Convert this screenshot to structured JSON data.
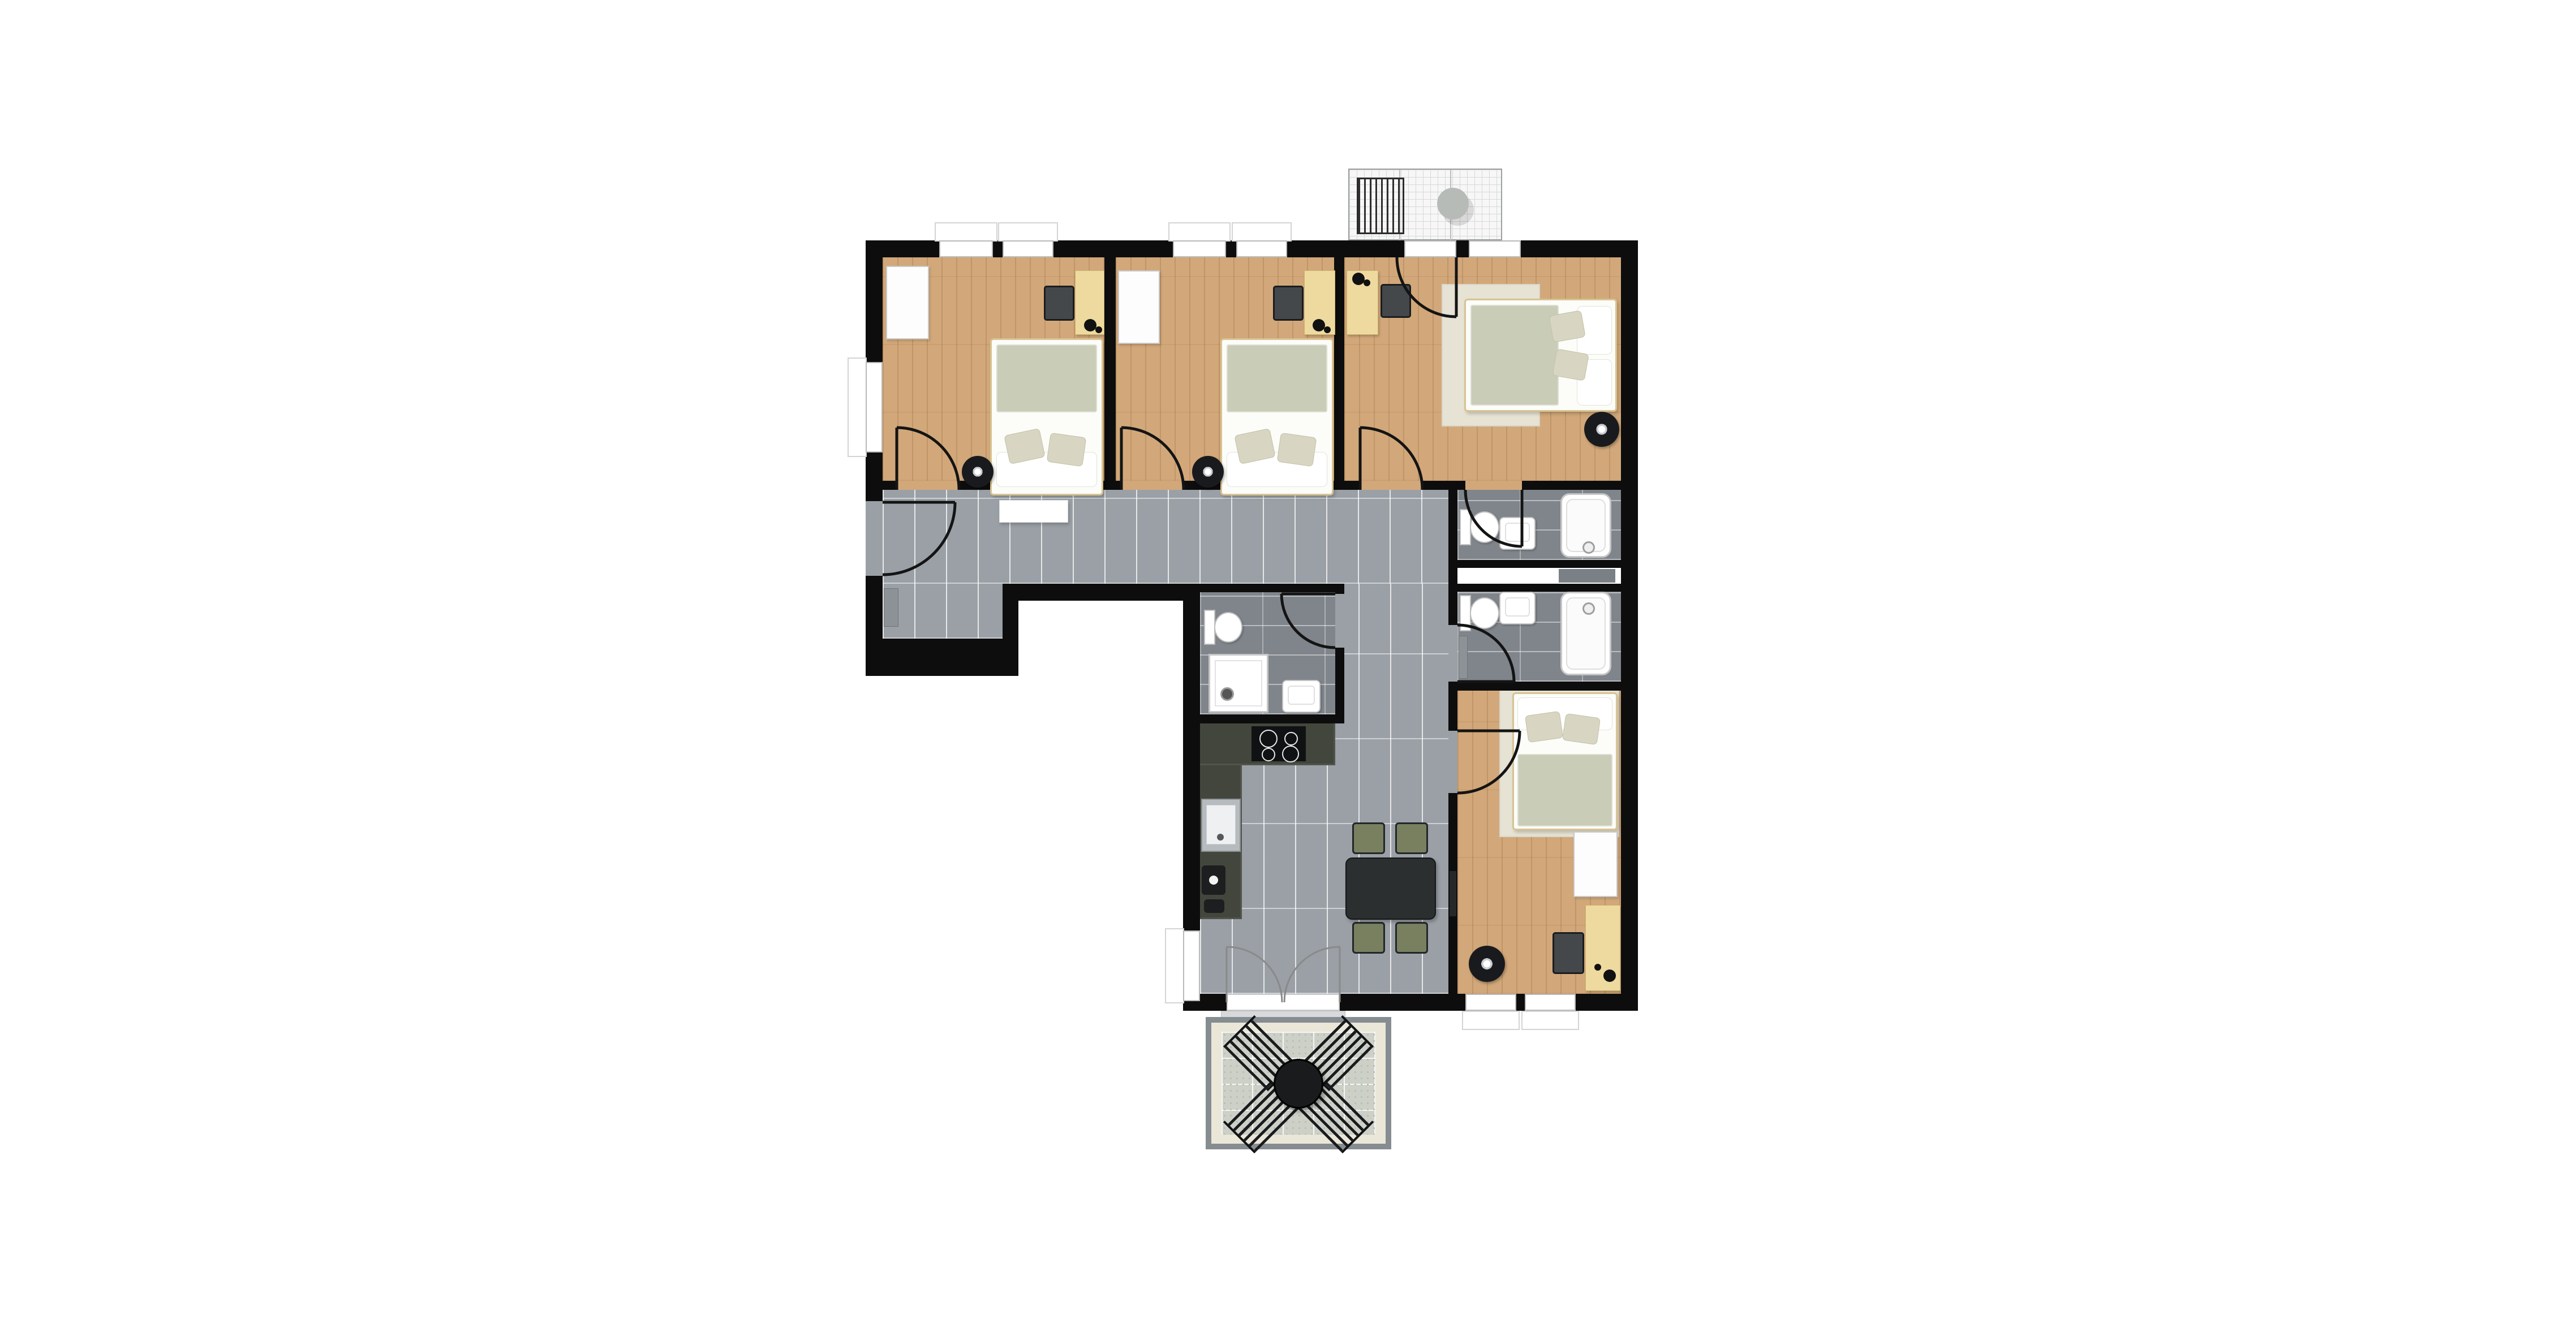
{
  "plan": {
    "type": "apartment-floor-plan",
    "orientation": "top-down",
    "colors": {
      "background": "#ffffff",
      "walls": "#0d0d0d",
      "wood_floor": "#d2a87a",
      "hall_tile": "#9aa0a6",
      "bath_tile": "#80858c",
      "blanket_sage": "#c9cdb7",
      "kitchen_counter": "#43463c",
      "dining_chair_green": "#78805f",
      "balcony_stone": "#ccd0c7",
      "balcony_border_cream": "#eae7d9",
      "balcony_frame_gray": "#868d91"
    },
    "counts": {
      "bedrooms": 4,
      "bathrooms": 3,
      "balconies": 2
    },
    "rooms": [
      {
        "id": "bedroom-1",
        "name": "bedroom top-left",
        "furniture": [
          "single-bed",
          "sage-blanket",
          "pillows",
          "wardrobe",
          "desk",
          "desk-chair",
          "desk-lamp",
          "floor-lamp",
          "door-to-hallway",
          "window-top",
          "window-left"
        ]
      },
      {
        "id": "bedroom-2",
        "name": "bedroom top-middle",
        "furniture": [
          "single-bed",
          "sage-blanket",
          "pillows",
          "wardrobe",
          "desk",
          "desk-chair",
          "desk-lamp",
          "floor-lamp",
          "door-to-hallway",
          "window-top-1",
          "window-top-2"
        ]
      },
      {
        "id": "bedroom-3",
        "name": "bedroom top-right",
        "furniture": [
          "double-bed",
          "rug",
          "pillows",
          "desk",
          "desk-chair",
          "desk-lamp",
          "floor-lamp",
          "door-to-hallway",
          "door-to-upper-balcony",
          "window-top",
          "door-to-ensuite-bathroom"
        ]
      },
      {
        "id": "bedroom-4",
        "name": "bedroom bottom-right",
        "furniture": [
          "double-bed",
          "rug",
          "pillows",
          "wardrobe",
          "desk",
          "desk-chair",
          "desk-lamp",
          "floor-lamp",
          "door-to-corridor",
          "window-bottom-1",
          "window-bottom-2"
        ]
      },
      {
        "id": "bathroom-1",
        "name": "ensuite bathroom",
        "furniture": [
          "toilet",
          "washbasin",
          "bathtub",
          "door-to-bedroom-3"
        ]
      },
      {
        "id": "bathroom-2",
        "name": "shared bathroom",
        "furniture": [
          "toilet",
          "washbasin",
          "bathtub",
          "radiator",
          "door-to-corridor"
        ]
      },
      {
        "id": "shower-room",
        "name": "shower room",
        "furniture": [
          "toilet",
          "washbasin",
          "shower",
          "door-to-corridor"
        ]
      },
      {
        "id": "hallway",
        "name": "entrance hallway",
        "furniture": [
          "entry-door",
          "doormat",
          "radiator"
        ]
      },
      {
        "id": "kitchen",
        "name": "open kitchen",
        "furniture": [
          "l-shaped-counter",
          "cooktop-4-burners",
          "kitchen-sink",
          "coffee-machine"
        ]
      },
      {
        "id": "dining-area",
        "name": "dining area",
        "furniture": [
          "rectangular-table",
          "dining-chair",
          "dining-chair",
          "dining-chair",
          "dining-chair",
          "radiator",
          "french-doors-to-balcony"
        ]
      },
      {
        "id": "upper-balcony",
        "name": "small balcony top",
        "furniture": [
          "lounge-chair",
          "round-side-table"
        ]
      },
      {
        "id": "lower-balcony",
        "name": "terrace bottom",
        "furniture": [
          "round-table",
          "patio-chair",
          "patio-chair",
          "patio-chair",
          "patio-chair"
        ]
      }
    ]
  }
}
